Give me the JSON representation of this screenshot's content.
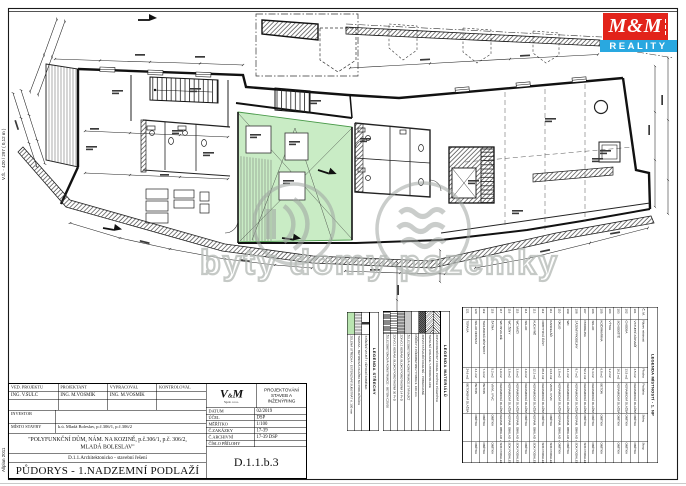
{
  "margin_notes": {
    "size_note": "V.Š. - 420 / 297 ( 0,12 m )",
    "cad_note": "Allplan 2011"
  },
  "watermark": {
    "text": "byty domy pozemky"
  },
  "logo_mm": {
    "top": "M&M",
    "bottom": "REALITY",
    "red": "#e2231a",
    "blue": "#29a8e0"
  },
  "legend_roof": {
    "title": "LEGENDA STŘECHY",
    "items": [
      {
        "label": "ZELENÁ STŘECHA - EXTENZIVNÍ SUBSTRÁT tl. 100 mm",
        "sw": "sw-green"
      },
      {
        "label": "TERASA - BETONOVÁ DLAŽBA NA PODLOŽKÁCH",
        "sw": "sw-glines"
      },
      {
        "label": "STŘEŠNÍ VPUSŤ / VĚTRACÍ KOMÍNEK",
        "sw": "sw-vent"
      }
    ]
  },
  "legend_materials": {
    "title": "LEGENDA MATERIÁLŮ",
    "items": [
      {
        "label": "ŽELEZOBETONOVÁ KONSTRUKCE - BETON C25/30",
        "sw": "sw-vdense"
      },
      {
        "label": "ZDIVO Z KERAM. BLOKŮ POROTHERM 30 P+D",
        "sw": "sw-vlines"
      },
      {
        "label": "ZDIVO Z KERAM. BLOKŮ POROTHERM 14 P+D",
        "sw": "sw-vgray"
      },
      {
        "label": "ŽELEZOBETONOVÁ KONSTRUKCE STÁVAJÍCÍ",
        "sw": "sw-gray"
      },
      {
        "label": "PŘÍČKY Z PÓROBETONU YTONG tl. 100 mm",
        "sw": "sw-white"
      },
      {
        "label": "ZDIVO STÁVAJÍCÍ CIHELNÉ - PONECHANÉ",
        "sw": "sw-dark"
      },
      {
        "label": "TEPELNÁ IZOLACE / HYDROIZOLACE",
        "sw": "sw-diag"
      },
      {
        "label": "ZDIVO DOZDÍVKY Z CIHEL PLNÝCH PÁLENÝCH",
        "sw": "sw-diag2"
      }
    ]
  },
  "rooms_table": {
    "title": "LEGENDA MÍSTNOSTÍ - 1. NP",
    "columns": [
      "Č. M.",
      "Název místnosti",
      "Plocha",
      "Podlaha",
      "Stěny",
      "Strop"
    ],
    "rows": [
      {
        "n": "101",
        "name": "VSTUPNÍ ZÁDVEŘÍ",
        "a": "4.5 m2",
        "f": "KERAMICKÁ DLAŽBA",
        "w": "OMÍTKA",
        "c": "OMÍTKA"
      },
      {
        "n": "102",
        "name": "CHODBA",
        "a": "13.5 m2",
        "f": "KERAMICKÁ DLAŽBA",
        "w": "OMÍTKA",
        "c": "OMÍTKA"
      },
      {
        "n": "103",
        "name": "SCHODIŠTĚ",
        "a": "16.2 m2",
        "f": "KERAMICKÁ DLAŽBA",
        "w": "OMÍTKA",
        "c": "OMÍTKA"
      },
      {
        "n": "104",
        "name": "VÝTAH",
        "a": "3.2 m2",
        "f": "",
        "w": "",
        "c": ""
      },
      {
        "n": "105",
        "name": "KOČÁRKÁRNA",
        "a": "6.8 m2",
        "f": "BETON",
        "w": "OMÍTKA",
        "c": "OMÍTKA"
      },
      {
        "n": "106",
        "name": "SKLAD",
        "a": "5.4 m2",
        "f": "KERAMICKÁ DLAŽBA",
        "w": "OMÍTKA",
        "c": "OMÍTKA"
      },
      {
        "n": "107",
        "name": "PRODEJNA",
        "a": "52.3 m2",
        "f": "KERAMICKÁ DLAŽBA",
        "w": "OMÍTKA",
        "c": "SDK PODHLED"
      },
      {
        "n": "108",
        "name": "ZÁZEMÍ PRODEJNY",
        "a": "8.7 m2",
        "f": "KERAMICKÁ DLAŽBA",
        "w": "KERAM. OBKLAD + OMÍTKA",
        "c": "SDK PODHLED"
      },
      {
        "n": "109",
        "name": "WC",
        "a": "2.1 m2",
        "f": "KERAMICKÁ DLAŽBA",
        "w": "KERAM. OBKLAD + OMÍTKA",
        "c": "OMÍTKA"
      },
      {
        "n": "110",
        "name": "ÚKLID",
        "a": "1.8 m2",
        "f": "KERAMICKÁ DLAŽBA",
        "w": "KERAM. OBKLAD + OMÍTKA",
        "c": "OMÍTKA"
      },
      {
        "n": "111",
        "name": "KANCELÁŘ",
        "a": "14.6 m2",
        "f": "VINYL / PVC",
        "w": "OMÍTKA",
        "c": "SDK PODHLED"
      },
      {
        "n": "112",
        "name": "ODBYTOVÁ ČÁST",
        "a": "68.4 m2",
        "f": "KERAMICKÁ DLAŽBA",
        "w": "OMÍTKA",
        "c": "SDK PODHLED"
      },
      {
        "n": "113",
        "name": "KUCHYNĚ",
        "a": "12.3 m2",
        "f": "KERAMICKÁ DLAŽBA",
        "w": "KERAM. OBKLAD + OMÍTKA",
        "c": "SDK PODHLED"
      },
      {
        "n": "114",
        "name": "SKLAD",
        "a": "4.9 m2",
        "f": "KERAMICKÁ DLAŽBA",
        "w": "OMÍTKA",
        "c": "OMÍTKA"
      },
      {
        "n": "115",
        "name": "WC MUŽI",
        "a": "3.6 m2",
        "f": "KERAMICKÁ DLAŽBA",
        "w": "KERAM. OBKLAD + OMÍTKA",
        "c": "SDK PODHLED"
      },
      {
        "n": "116",
        "name": "WC ŽENY",
        "a": "3.8 m2",
        "f": "KERAMICKÁ DLAŽBA",
        "w": "KERAM. OBKLAD + OMÍTKA",
        "c": "SDK PODHLED"
      },
      {
        "n": "117",
        "name": "WC INVALIDÉ",
        "a": "3.9 m2",
        "f": "KERAMICKÁ DLAŽBA",
        "w": "KERAM. OBKLAD + OMÍTKA",
        "c": "SDK PODHLED"
      },
      {
        "n": "118",
        "name": "ŠATNA",
        "a": "5.2 m2",
        "f": "VINYL / PVC",
        "w": "OMÍTKA",
        "c": "OMÍTKA"
      },
      {
        "n": "119",
        "name": "TECHNICKÁ MÍSTNOST",
        "a": "7.4 m2",
        "f": "BETON",
        "w": "OMÍTKA",
        "c": "OMÍTKA"
      },
      {
        "n": "120",
        "name": "SKLAD ODPADU",
        "a": "4.1 m2",
        "f": "BETON",
        "w": "OMÍTKA",
        "c": "OMÍTKA"
      },
      {
        "n": "121",
        "name": "TERASA",
        "a": "24.6 m2",
        "f": "BETONOVÁ DLAŽBA",
        "w": "",
        "c": ""
      }
    ]
  },
  "title_block": {
    "roles": [
      {
        "label": "VED. PROJEKTU",
        "value": "ING. V.ŠULC"
      },
      {
        "label": "PROJEKTANT",
        "value": "ING. M.VOSMÍK"
      },
      {
        "label": "VYPRACOVAL",
        "value": "ING. M.VOSMÍK"
      },
      {
        "label": "KONTROLOVAL",
        "value": ""
      }
    ],
    "investor_label": "INVESTOR",
    "investor_value": "",
    "misto_label": "MÍSTO STAVBY",
    "misto_value": "k.ú. Mladá Boleslav, p.č.306/1, p.č.306/2",
    "building_name_line1": "\"POLYFUNKČNÍ DŮM, NÁM. NA KOZINĚ, p.č.306/1, p.č. 306/2,",
    "building_name_line2": "MLADÁ BOLESLAV\"",
    "section": "D.1.1.Architektonicko - stavební řešení",
    "drawing_title": "PŮDORYS - 1.NADZEMNÍ PODLAŽÍ",
    "firm": {
      "name_v": "V",
      "name_amp": "&",
      "name_m": "M",
      "sub": "Spol. s r.o.",
      "desc": "PROJEKTOVÁNÍ STAVEB A INŽENÝRING"
    },
    "meta": [
      {
        "label": "DATUM",
        "value": "02/2019"
      },
      {
        "label": "ÚČEL",
        "value": "DSP"
      },
      {
        "label": "MĚŘÍTKO",
        "value": "1/100"
      },
      {
        "label": "Č.ZAKÁZKY",
        "value": "17-39"
      },
      {
        "label": "Č.ARCHIVNÍ",
        "value": "17-39 DSP"
      },
      {
        "label": "ČÍSLO PŘÍLOHY",
        "value": ""
      }
    ],
    "drawing_number": "D.1.1.b.3"
  }
}
